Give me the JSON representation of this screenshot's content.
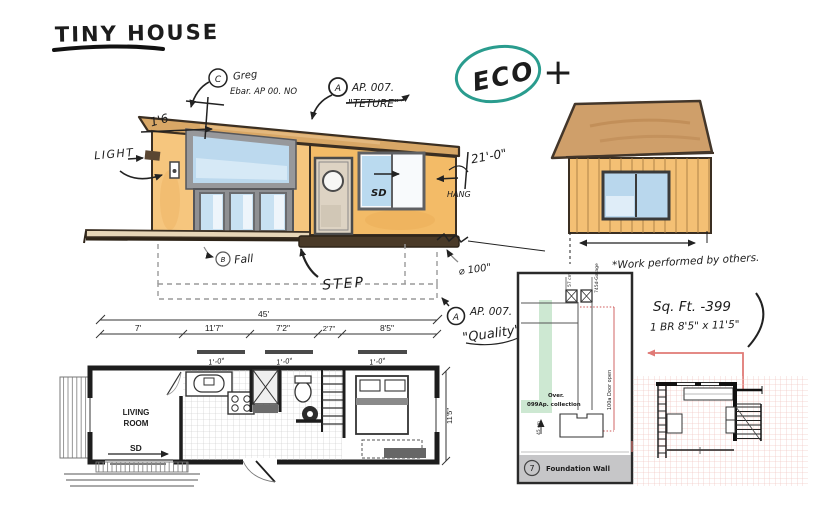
{
  "title": "TINY HOUSE",
  "badge": {
    "eco": "ECO",
    "plus": "+"
  },
  "front": {
    "note_c": {
      "letter": "C",
      "name": "Greg",
      "code": "Ebar. AP 00. NO"
    },
    "note_a": {
      "letter": "A",
      "code": "AP. 007.",
      "word": "\"TETURE\""
    },
    "dim_left": "1'6",
    "light": "LIGHT",
    "sd": "SD",
    "note_b": {
      "letter": "B",
      "word": "Fall"
    },
    "step": "STEP",
    "hang": "HANG",
    "dim_right": "21'-0\"",
    "dim_phi": "⌀ 100\""
  },
  "rear": {
    "note": "*Work performed by others."
  },
  "specs": {
    "sqft": "Sq. Ft.  -399",
    "bed": "1 BR 8'5\" x 11'5\""
  },
  "quality": {
    "letter": "A",
    "code": "AP. 007.",
    "word": "\"Quality\""
  },
  "plan": {
    "dim_total": "45'",
    "dims": [
      "7'",
      "11'7\"",
      "7'2\"",
      "2'7\"",
      "8'5\""
    ],
    "win_notes": [
      "1'-0\"",
      "1'-0\"",
      "1'-0\""
    ],
    "room1": "LIVING",
    "room2": "ROOM",
    "sd": "SD",
    "dim_height": "11'5\""
  },
  "detail": {
    "cm57": "57 cm",
    "garage": "745d-Garage",
    "over": "Over.",
    "collection": "099Ap. collection",
    "door": "100a Door open",
    "cm45": "45 cm",
    "num": "7",
    "label": "Foundation Wall"
  },
  "colors": {
    "ink": "#1c1c1c",
    "teal": "#2a9c8e",
    "red": "#e07a76",
    "wall": "#f5c47b",
    "roof": "#d2a269",
    "window": "#bcd9ee",
    "green": "#cde8d2",
    "grid_pink": "#f2cbc8",
    "gray_band": "#c6c6c8"
  }
}
